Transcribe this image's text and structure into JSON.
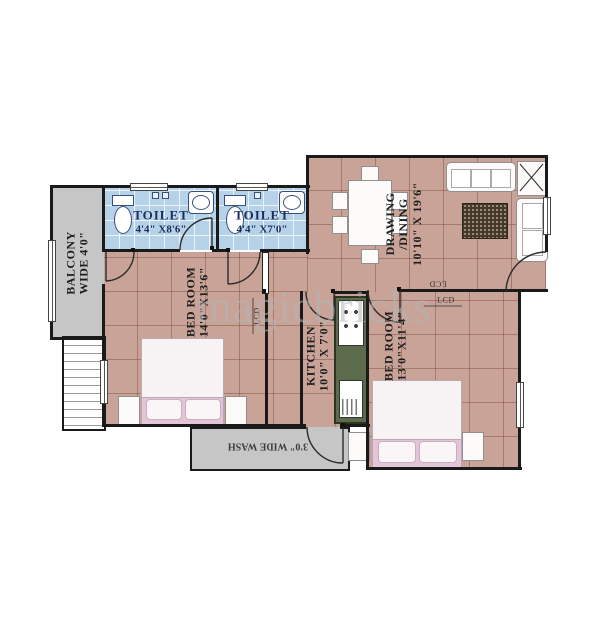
{
  "watermark": "magicbricks",
  "rooms": {
    "balcony": {
      "name": "BALCONY",
      "dim": "WIDE 4'0\""
    },
    "toilet1": {
      "name": "TOILET",
      "dim": "4'4\" X8'6\""
    },
    "toilet2": {
      "name": "TOILET",
      "dim": "4'4\" X7'0\""
    },
    "drawing_dining": {
      "line1": "DRAWING",
      "line2": "/DINING",
      "dim": "10'10\" X 19'6\""
    },
    "bedroom1": {
      "name": "BED ROOM",
      "dim": "14'0\"X13'6\""
    },
    "kitchen": {
      "name": "KITCHEN",
      "dim": "10'0\" X 7'0\""
    },
    "bedroom2": {
      "name": "BED ROOM",
      "dim": "13'0\"X11'4\""
    },
    "wash": {
      "label": "3'0\" WIDE WASH"
    }
  },
  "annotations": {
    "lcd_corridor": "LCD",
    "lcd_drawing": "LCD",
    "lcd_bedroom2": "LCD"
  },
  "colors": {
    "floor": "#c9a397",
    "floor_grid": "#7d5242",
    "toilet_floor": "#b5d2e8",
    "balcony_gray": "#c6c6c6",
    "wall": "#1a1a1a",
    "kitchen_counter": "#5c6b4b",
    "bed_pink": "#e2c5d9",
    "toilet_label_navy": "#1c2c5e",
    "watermark_gray": "#b5b5b5"
  }
}
